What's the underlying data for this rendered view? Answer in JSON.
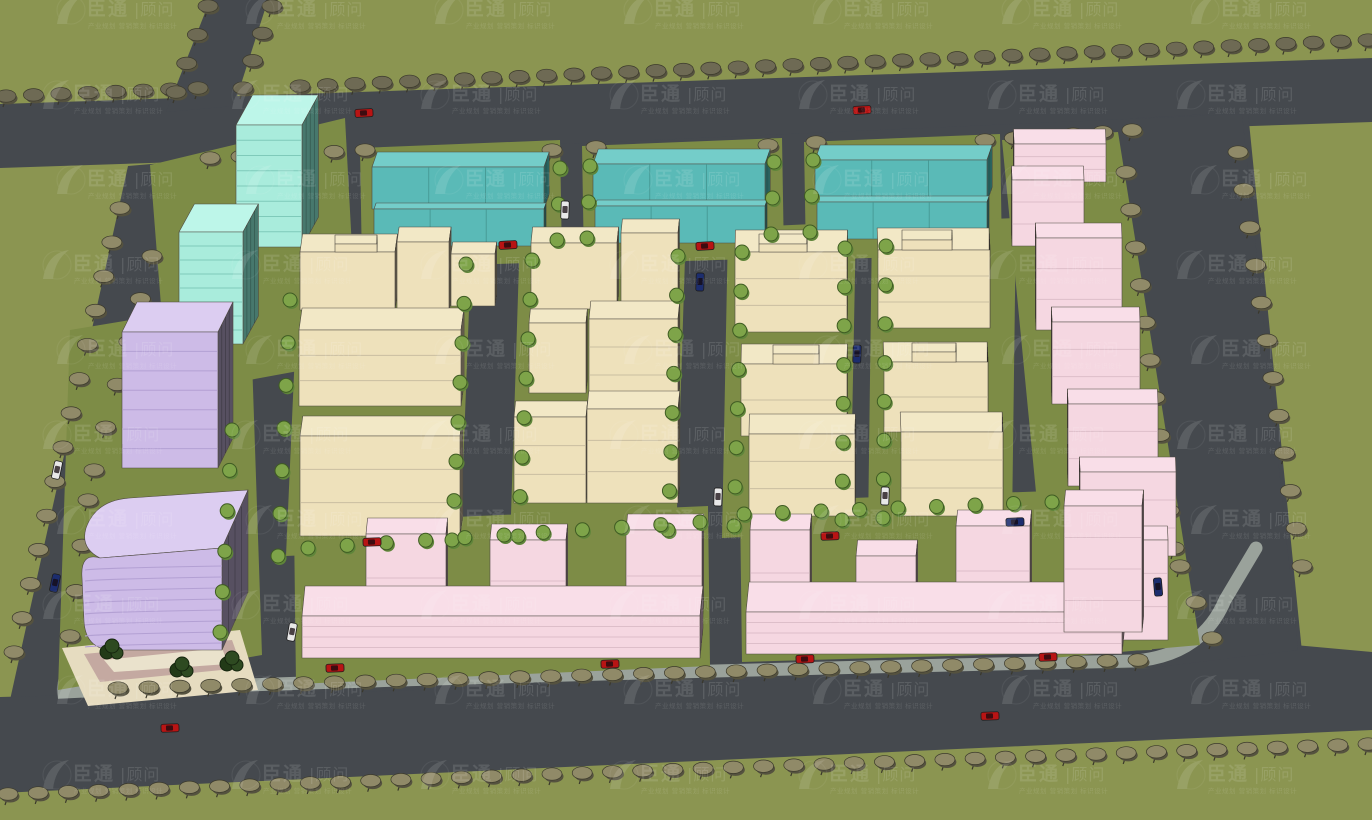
{
  "image_type": "3d-aerial-masterplan-rendering",
  "watermark": {
    "brand": "臣通",
    "suffix": "|顾问",
    "tagline": "产业规划 营销策划 标识设计",
    "logo": "leaf-swoosh",
    "color": "#ffffff",
    "opacity": 0.12
  },
  "palette": {
    "grass": "#8b9551",
    "pad": "#7d8c46",
    "road": "#45494e",
    "sidewalk": "#9aa29b",
    "outline": "#4f4a42",
    "mint": {
      "top": "#bdf6e9",
      "front": "#a9ecdc",
      "side": "#47786d",
      "band": "#7fcaba"
    },
    "teal": {
      "top": "#74cdc9",
      "front": "#5abab7",
      "side": "#2f6f6c",
      "band": "#43948f"
    },
    "cream": {
      "top": "#f2e8c6",
      "front": "#eee1bb",
      "side": "#837965",
      "band": "#c9bea0"
    },
    "purple": {
      "top": "#dccdf1",
      "front": "#cdbbe7",
      "side": "#575061",
      "band": "#b3a0d3"
    },
    "pink": {
      "top": "#f9dee8",
      "front": "#f5d7e1",
      "side": "#8a7280",
      "band": "#ddbec9"
    },
    "treeOuter": "#908a68",
    "treeDark": "#6e6a54",
    "treeBright": "#7ea449",
    "treePlaza": "#2e4a21",
    "carRed": "#b81414",
    "carWhite": "#e8e8e8",
    "carBlue": "#1c2d6e",
    "plazaTan": "#e6dcc0",
    "plazaMauve": "#c4a9a1",
    "plazaCream": "#eae2cc"
  },
  "scene": {
    "setting": "industrial-park master plan, aerial three-quarter rendering",
    "ground": {
      "grass": "olive green lawns",
      "roads": "dark asphalt boulevards lined with street trees"
    },
    "building_groups": [
      {
        "name": "twin-highrise-towers",
        "color_key": "mint",
        "count": 2,
        "location": "north-west"
      },
      {
        "name": "workshop-halls",
        "color_key": "teal",
        "count": 3,
        "location": "north row"
      },
      {
        "name": "office-slabs-rounded-tower",
        "color_key": "purple",
        "count": 2,
        "location": "west"
      },
      {
        "name": "factory-blocks",
        "color_key": "cream",
        "count": 17,
        "location": "central grid"
      },
      {
        "name": "stepped-terrace-chain",
        "color_key": "pink",
        "count": 7,
        "location": "east edge"
      },
      {
        "name": "row-buildings-with-raised-sections",
        "color_key": "pink",
        "count": 2,
        "location": "south"
      }
    ],
    "vehicles": {
      "red": 12,
      "white": 5,
      "blue": 5
    },
    "landscape": {
      "street_trees": "grey-olive canopies along boundary roads",
      "courtyard_trees": "bright green trees along internal streets",
      "plaza": "paved corner plaza with dark green trees at the south-west tower"
    }
  }
}
